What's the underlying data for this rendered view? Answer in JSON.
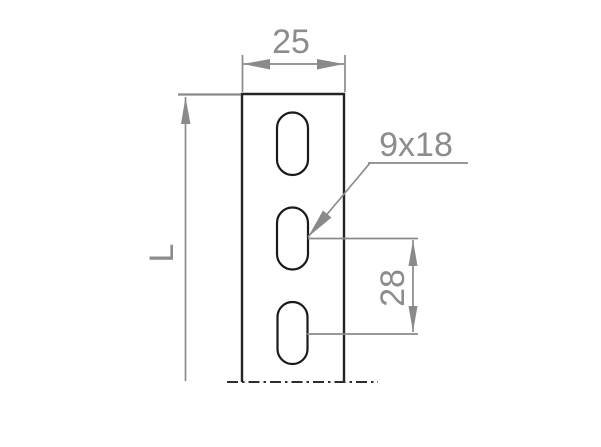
{
  "drawing": {
    "dimensions": {
      "width_label": "25",
      "length_label": "L",
      "slot_size_label": "9x18",
      "slot_spacing_label": "28"
    },
    "colors": {
      "background": "#ffffff",
      "part_outline": "#242424",
      "slot_outline": "#1a1a1a",
      "dimension_lines": "#8a8a8a",
      "dimension_text": "#8c8c8c",
      "chain_line": "#2e2e2e"
    }
  }
}
